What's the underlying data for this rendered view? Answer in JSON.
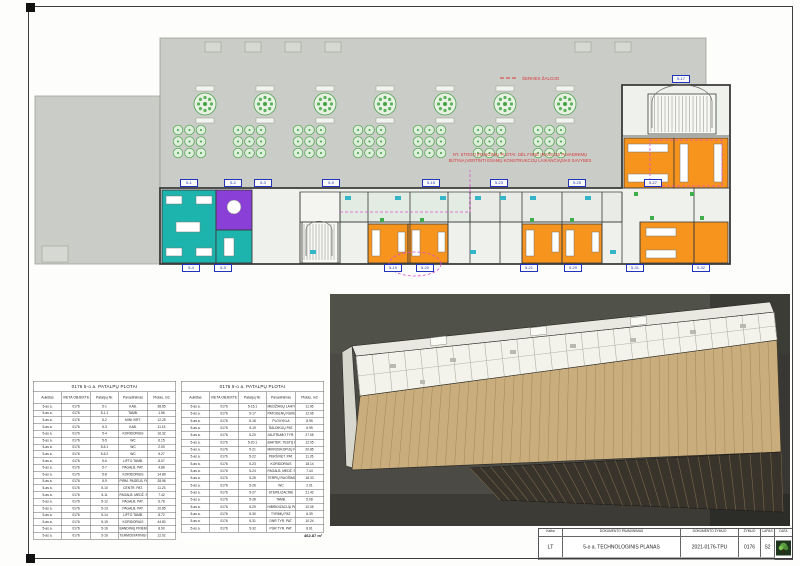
{
  "plan": {
    "note_top": "ŠERHES ŽALOJO",
    "note_line1": "NT. STOGO ĮRENGINIŲ PLOTAI. DĖL FONE ĮRANGOS PAVADINIMŲ",
    "note_line2": "BŪTINA ĮVERTINTI ESAMŲ KONSTRUKCIJŲ LAIKANČIĄSIAS SAVYBES",
    "room_tags": [
      "5-1",
      "5-2",
      "5-3",
      "5-9",
      "5-15",
      "5-23",
      "5-25",
      "5-27",
      "5-4",
      "5-5",
      "5-19",
      "5-20",
      "5-21",
      "5-29",
      "5-31",
      "5-32",
      "5-17"
    ]
  },
  "tables": [
    {
      "title": "0176 5-o a. PATALPŲ PLOTAI",
      "headers": [
        "Aukštas",
        "VIETA OBJEKTE",
        "Patalpų Nr.",
        "Pavadinimas",
        "Plotas, m2"
      ],
      "rows": [
        [
          "5-as a.",
          "0176",
          "5-1",
          "KAB.",
          "38.65"
        ],
        [
          "5-as a.",
          "0176",
          "5-1.1",
          "TAMB.",
          "1.56"
        ],
        [
          "5-as a.",
          "0176",
          "5-2",
          "MINI VIRT.",
          "12.25"
        ],
        [
          "5-as a.",
          "0176",
          "5-3",
          "KAB.",
          "11.15"
        ],
        [
          "5-as a.",
          "0176",
          "5-4",
          "KORIDORIUS",
          "16.32"
        ],
        [
          "5-as a.",
          "0176",
          "5-5",
          "WC",
          "6.15"
        ],
        [
          "5-as a.",
          "0176",
          "5-5.1",
          "WC",
          "2.00"
        ],
        [
          "5-as a.",
          "0176",
          "5-5.2",
          "WC",
          "5.27"
        ],
        [
          "5-as a.",
          "0176",
          "5-6",
          "LIFTO TAMB.",
          "8.07"
        ],
        [
          "5-as a.",
          "0176",
          "5-7",
          "PAGALB. PAT.",
          "4.86"
        ],
        [
          "5-as a.",
          "0176",
          "5-8",
          "KORIDORIUS",
          "14.89"
        ],
        [
          "5-as a.",
          "0176",
          "5-9",
          "PIRM. PAGELB. PAT.",
          "28.96"
        ],
        [
          "5-as a.",
          "0176",
          "5-10",
          "CENTR. PAT.",
          "11.23"
        ],
        [
          "5-as a.",
          "0176",
          "5-11",
          "PAGALB. MEDŽ. SAND.",
          "7.42"
        ],
        [
          "5-as a.",
          "0176",
          "5-12",
          "PAGALB. PAT.",
          "6.78"
        ],
        [
          "5-as a.",
          "0176",
          "5-13",
          "PAGALB. PAT.",
          "10.85"
        ],
        [
          "5-as a.",
          "0176",
          "5-14",
          "LIFTO TAMB.",
          "8.72"
        ],
        [
          "5-as a.",
          "0176",
          "5-15",
          "KORIDORIUS",
          "44.80"
        ],
        [
          "5-as a.",
          "0176",
          "5-16",
          "BANDINIŲ PRIĖMIMO PAT.",
          "8.90"
        ],
        [
          "5-as a.",
          "0176",
          "5-16",
          "TERMOSTATINIS KAB.",
          "12.02"
        ]
      ]
    },
    {
      "title": "0176 5-o a. PATALPŲ PLOTAI",
      "headers": [
        "Aukštas",
        "VIETA OBJEKTE",
        "Patalpų Nr.",
        "Pavadinimas",
        "Plotas, m2"
      ],
      "rows": [
        [
          "5-as a.",
          "0176",
          "5-16.1",
          "MEDŽIAGŲ LAIKYMO PAT.",
          "11.06"
        ],
        [
          "5-as a.",
          "0176",
          "5-17",
          "PATOGENŲ NUKENKSMINIMO PAT.",
          "12.06"
        ],
        [
          "5-as a.",
          "0176",
          "5-18",
          "PLOVYKLA",
          "8.95"
        ],
        [
          "5-as a.",
          "0176",
          "5-19",
          "ŠALDIKLIŲ PAT.",
          "6.95"
        ],
        [
          "5-as a.",
          "0176",
          "5-20",
          "JAUTRUMO TYR. PAT.",
          "27.05"
        ],
        [
          "5-as a.",
          "0176",
          "5-20.1",
          "BAKTER. TESTŲ PAT.",
          "12.05"
        ],
        [
          "5-as a.",
          "0176",
          "5-21",
          "MIKROSKOPIJŲ PAT.",
          "20.85"
        ],
        [
          "5-as a.",
          "0176",
          "5-22",
          "PERŠVIET. PAT.",
          "11.26"
        ],
        [
          "5-as a.",
          "0176",
          "5-23",
          "KORIDORIUS",
          "18.14"
        ],
        [
          "5-as a.",
          "0176",
          "5-24",
          "PAGALB. MEDŽ. SAND.",
          "7.44"
        ],
        [
          "5-as a.",
          "0176",
          "5-25",
          "TERPIŲ RUOŠIMO PAT.",
          "18.33"
        ],
        [
          "5-as a.",
          "0176",
          "5-26",
          "WC",
          "2.01"
        ],
        [
          "5-as a.",
          "0176",
          "5-27",
          "STERILIZACINĖ",
          "21.42"
        ],
        [
          "5-as a.",
          "0176",
          "5-28",
          "TAMB.",
          "5.08"
        ],
        [
          "5-as a.",
          "0176",
          "5-29",
          "HIBRIDIZACIJŲ PAT.",
          "10.05"
        ],
        [
          "5-as a.",
          "0176",
          "5-30",
          "TYRIMŲ PAT.",
          "6.39"
        ],
        [
          "5-as a.",
          "0176",
          "5-31",
          "DNR TYR. PAT.",
          "10.24"
        ],
        [
          "5-as a.",
          "0176",
          "5-32",
          "PGR TYR. PAT.",
          "8.01"
        ]
      ],
      "total": "462.87 m²"
    }
  ],
  "titleblock": {
    "kalba_label": "Kalba",
    "kalba": "LT",
    "doc_name_label": "DOKUMENTO PAVADINIMAS",
    "doc_name": "5-o a. TECHNOLOGINIS PLANAS",
    "doc_code_label": "DOKUMENTO ŽYMUO",
    "doc_code": "2021-0176-TPU",
    "zymuo_label": "ŽYMUO",
    "zymuo": "0176",
    "lapas_label": "LAPAS",
    "lapas": "S2",
    "data_label": "DATA",
    "logo_icon": "green-tree-logo"
  },
  "colors": {
    "teal_room": "#1db4ae",
    "purple_room": "#8a3fd6",
    "orange_room": "#f7941d",
    "roof_slab_gray": "#caccc7",
    "tag_blue": "#2233bb",
    "magenta_annotation": "#d94fd0",
    "red_annotation": "#d93a3a",
    "deck_tan": "#c9ad7c",
    "iso_background": "#4b4a44",
    "planting_green": "#4aa04a"
  }
}
